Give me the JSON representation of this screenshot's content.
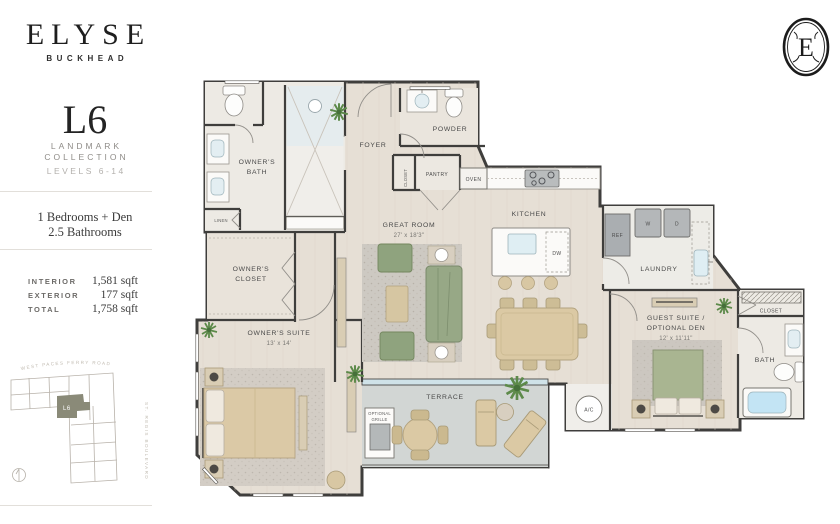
{
  "sidebar": {
    "brand": "ELYSE",
    "brand_sub": "BUCKHEAD",
    "plan_code": "L6",
    "collection_line1": "LANDMARK",
    "collection_line2": "COLLECTION",
    "levels": "LEVELS 6-14",
    "bedrooms": "1 Bedrooms + Den",
    "bathrooms": "2.5 Bathrooms",
    "areas": [
      {
        "label": "INTERIOR",
        "value": "1,581 sqft"
      },
      {
        "label": "EXTERIOR",
        "value": "177 sqft"
      },
      {
        "label": "TOTAL",
        "value": "1,758 sqft"
      }
    ],
    "keyplan": {
      "road_top": "WEST PACES FERRY ROAD",
      "road_right": "ST. REGIS BOULEVARD",
      "unit": "L6"
    }
  },
  "monogram_letter": "E",
  "plan": {
    "owners_bath_l1": "OWNER'S",
    "owners_bath_l2": "BATH",
    "linen": "LINEN",
    "foyer": "FOYER",
    "foyer_closet": "CLOSET",
    "powder": "POWDER",
    "pantry": "PANTRY",
    "oven": "OVEN",
    "great_room": "GREAT ROOM",
    "great_room_dims": "27' x 18'3\"",
    "kitchen": "KITCHEN",
    "dw": "DW",
    "ref": "REF",
    "washer": "W",
    "dryer": "D",
    "laundry": "LAUNDRY",
    "owners_closet_l1": "OWNER'S",
    "owners_closet_l2": "CLOSET",
    "owners_suite": "OWNER'S SUITE",
    "owners_suite_dims": "13' x 14'",
    "guest_suite_l1": "GUEST SUITE /",
    "guest_suite_l2": "OPTIONAL DEN",
    "guest_suite_dims": "12' x 11'11\"",
    "guest_closet": "CLOSET",
    "bath": "BATH",
    "terrace": "TERRACE",
    "optional_grille_l1": "OPTIONAL",
    "optional_grille_l2": "GRILLE",
    "ac": "A/C"
  },
  "colors": {
    "wall": "#3f3e3c",
    "wood_floor": "#e6dfd5",
    "tile_floor": "#edeae4",
    "terrace_floor": "#d2d6d4",
    "accent_green": "#93a682",
    "accent_tan": "#dbc9a6",
    "glass_blue": "#cfe2e8",
    "keyplan_unit": "#8a8a78"
  }
}
